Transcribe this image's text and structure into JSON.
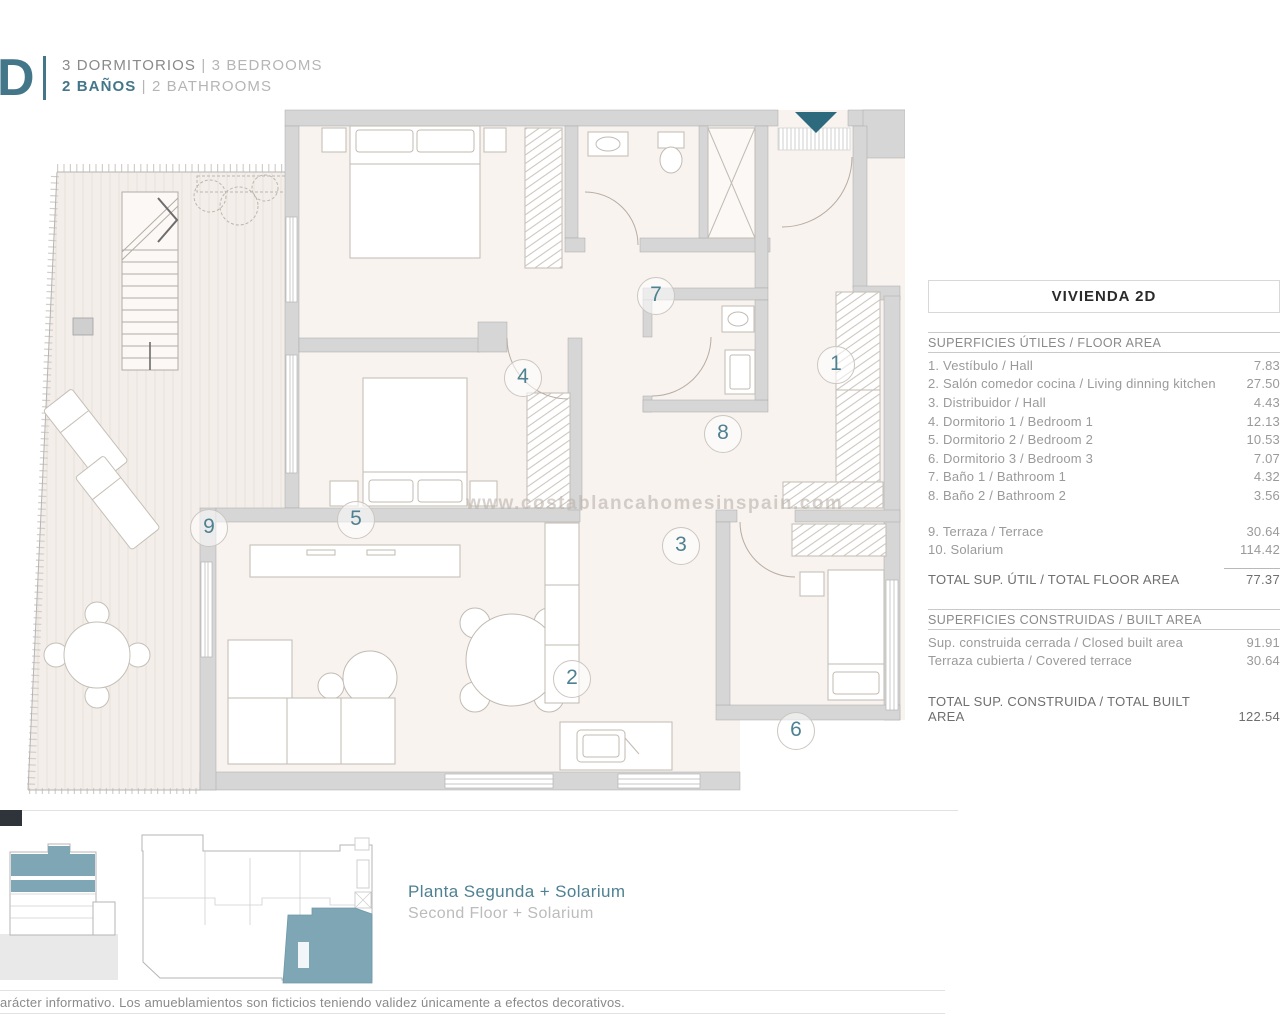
{
  "header": {
    "logo": "D",
    "sep": "|",
    "bedrooms_es": "3 DORMITORIOS",
    "bedrooms_en": "3 BEDROOMS",
    "bathrooms_es": "2 BAÑOS",
    "bathrooms_en": "2 BATHROOMS"
  },
  "plan": {
    "watermark": "www.costablancahomesinspain.com",
    "rooms": [
      "1",
      "2",
      "3",
      "4",
      "5",
      "6",
      "7",
      "8",
      "9"
    ]
  },
  "table": {
    "title": "VIVIENDA 2D",
    "floor": {
      "header": "SUPERFICIES ÚTILES / FLOOR AREA",
      "rows": [
        {
          "label": "1. Vestíbulo / Hall",
          "value": "7.83"
        },
        {
          "label": "2. Salón comedor cocina / Living dinning kitchen",
          "value": "27.50"
        },
        {
          "label": "3. Distribuidor / Hall",
          "value": "4.43"
        },
        {
          "label": "4. Dormitorio 1 / Bedroom 1",
          "value": "12.13"
        },
        {
          "label": "5. Dormitorio 2 / Bedroom 2",
          "value": "10.53"
        },
        {
          "label": "6. Dormitorio 3 / Bedroom 3",
          "value": "7.07"
        },
        {
          "label": "7. Baño 1 / Bathroom 1",
          "value": "4.32"
        },
        {
          "label": "8. Baño 2 / Bathroom 2",
          "value": "3.56"
        },
        {
          "label": "9. Terraza / Terrace",
          "value": "30.64"
        },
        {
          "label": "10. Solarium",
          "value": "114.42"
        }
      ],
      "total_label": "TOTAL SUP. ÚTIL / TOTAL FLOOR AREA",
      "total_value": "77.37"
    },
    "built": {
      "header": "SUPERFICIES CONSTRUIDAS / BUILT AREA",
      "rows": [
        {
          "label": "Sup. construida cerrada / Closed built area",
          "value": "91.91"
        },
        {
          "label": "Terraza cubierta / Covered terrace",
          "value": "30.64"
        }
      ],
      "total_label": "TOTAL SUP. CONSTRUIDA /  TOTAL BUILT AREA",
      "total_value": "122.54"
    }
  },
  "keyplan": {
    "title_es": "Planta Segunda + Solarium",
    "title_en": "Second Floor + Solarium"
  },
  "footer": {
    "disclaimer": "arácter informativo. Los amueblamientos son ficticios teniendo validez únicamente a efectos decorativos."
  },
  "colors": {
    "accent": "#44768a",
    "accent_light": "#7ea6b4",
    "wall_gray": "#d6d6d6"
  }
}
